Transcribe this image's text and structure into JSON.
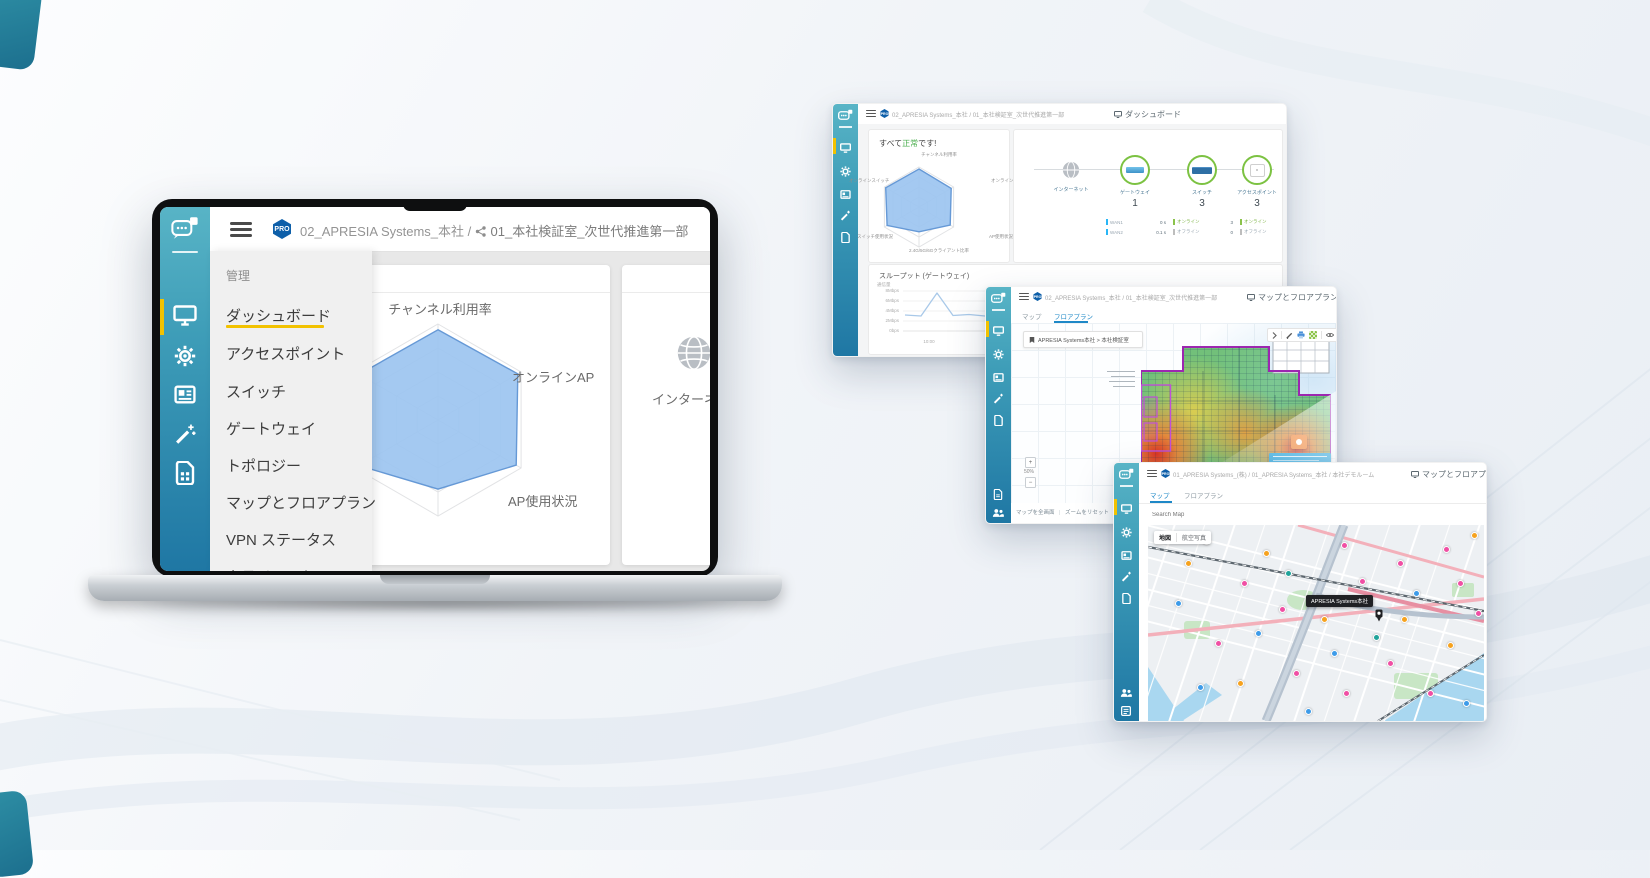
{
  "page": {
    "accent_teal": "#2E8FA5",
    "accent_yellow": "#F2C200",
    "sidebar_gradient_top": "#58B4C6",
    "sidebar_gradient_bottom": "#1F77A4",
    "pro_badge_color": "#0E5FA9"
  },
  "laptop": {
    "sidebar": {
      "icons": [
        "cloud-chat-logo",
        "monitor",
        "gear",
        "news-card",
        "magic-wand",
        "sim-card"
      ]
    },
    "header": {
      "pro": "PRO",
      "org": "02_APRESIA Systems_本社",
      "sep": "/",
      "site": "01_本社検証室_次世代推進第一部"
    },
    "menu": {
      "section": "管理",
      "items": [
        {
          "label": "ダッシュボード",
          "active": true
        },
        {
          "label": "アクセスポイント"
        },
        {
          "label": "スイッチ"
        },
        {
          "label": "ゲートウェイ"
        },
        {
          "label": "トポロジー"
        },
        {
          "label": "マップとフロアプラン"
        },
        {
          "label": "VPN ステータス"
        },
        {
          "label": "クライアント"
        }
      ]
    },
    "dashboard": {
      "radar_axis_top": "チャンネル利用率",
      "radar_axis_right": "オンラインAP",
      "radar_axis_bottom_right": "AP使用状況",
      "internet_label": "インターネット"
    }
  },
  "win_dashboard": {
    "header": {
      "pro": "PRO",
      "org": "02_APRESIA Systems_本社",
      "sep": "/",
      "site": "01_本社検証室_次世代推進第一部",
      "title": "ダッシュボード"
    },
    "status_card": {
      "prefix": "すべて",
      "status": "正常",
      "suffix": "です!",
      "status_color": "#4CAF50",
      "axes": {
        "top": "チャンネル利用率",
        "left": "オンラインスイッチ",
        "right": "オンラインAP",
        "bottom_left": "スイッチ使用状況",
        "bottom_right": "AP使用状況",
        "bottom": "2.4G/5G/6Gクライアント比率"
      }
    },
    "topology": {
      "internet_label": "インターネット",
      "nodes": [
        {
          "label": "ゲートウェイ",
          "count": "1",
          "device": "gateway",
          "stats": [
            {
              "name": "WAN1",
              "value": "0 s",
              "color": "#29B6F6"
            },
            {
              "name": "WAN2",
              "value": "0.1 s",
              "color": "#29B6F6"
            }
          ]
        },
        {
          "label": "スイッチ",
          "count": "3",
          "device": "switch",
          "stats": [
            {
              "name": "オンライン",
              "value": "3",
              "color": "#8BC34A"
            },
            {
              "name": "オフライン",
              "value": "0",
              "color": "#BDBDBD"
            }
          ]
        },
        {
          "label": "アクセスポイント",
          "count": "3",
          "device": "access-point",
          "stats": [
            {
              "name": "オンライン",
              "value": "3",
              "color": "#8BC34A"
            },
            {
              "name": "オフライン",
              "value": "0",
              "color": "#BDBDBD"
            }
          ]
        }
      ]
    },
    "throughput": {
      "title": "スループット (ゲートウェイ)",
      "ylabel": "通信量"
    }
  },
  "win_floorplan": {
    "header": {
      "pro": "PRO",
      "org": "02_APRESIA Systems_本社",
      "sep": "/",
      "site": "01_本社検証室_次世代推進第一部",
      "title": "マップとフロアプラン"
    },
    "tabs": [
      {
        "label": "マップ"
      },
      {
        "label": "フロアプラン",
        "active": true
      }
    ],
    "selector_label": "APRESIA Systems本社 > 本社検証室",
    "toolbar_icons": [
      "chevron-right",
      "pencil",
      "printer",
      "heatmap-grid",
      "eye"
    ],
    "zoom_in": "+",
    "zoom_value": "50%",
    "zoom_out": "−",
    "footer_left": "マップを全画面",
    "footer_sep": "|",
    "footer_right": "ズームをリセット"
  },
  "win_map": {
    "header": {
      "pro": "PRO",
      "breadcrumb": "01_APRESIA Systems_(株) / 01_APRESIA Systems_本社 / 本社デモルーム",
      "title": "マップとフロアプラン"
    },
    "tabs": [
      {
        "label": "マップ",
        "active": true
      },
      {
        "label": "フロアプラン"
      }
    ],
    "search_placeholder": "Search Map",
    "controls": {
      "map": "地図",
      "satellite": "航空写真"
    },
    "tooltip": "APRESIA Systems本社",
    "markers": [
      {
        "x": 58,
        "y": 16,
        "c": "#F04FA4"
      },
      {
        "x": 96,
        "y": 58,
        "c": "#F04FA4"
      },
      {
        "x": 134,
        "y": 84,
        "c": "#F04FA4"
      },
      {
        "x": 196,
        "y": 20,
        "c": "#F04FA4"
      },
      {
        "x": 214,
        "y": 56,
        "c": "#F04FA4"
      },
      {
        "x": 252,
        "y": 38,
        "c": "#F04FA4"
      },
      {
        "x": 298,
        "y": 24,
        "c": "#F04FA4"
      },
      {
        "x": 312,
        "y": 58,
        "c": "#F04FA4"
      },
      {
        "x": 330,
        "y": 88,
        "c": "#F04FA4"
      },
      {
        "x": 70,
        "y": 118,
        "c": "#F04FA4"
      },
      {
        "x": 148,
        "y": 148,
        "c": "#F04FA4"
      },
      {
        "x": 198,
        "y": 168,
        "c": "#F04FA4"
      },
      {
        "x": 242,
        "y": 138,
        "c": "#F04FA4"
      },
      {
        "x": 282,
        "y": 168,
        "c": "#F04FA4"
      },
      {
        "x": 40,
        "y": 38,
        "c": "#F6A21E"
      },
      {
        "x": 118,
        "y": 28,
        "c": "#F6A21E"
      },
      {
        "x": 176,
        "y": 94,
        "c": "#F6A21E"
      },
      {
        "x": 256,
        "y": 94,
        "c": "#F6A21E"
      },
      {
        "x": 326,
        "y": 10,
        "c": "#F6A21E"
      },
      {
        "x": 92,
        "y": 158,
        "c": "#F6A21E"
      },
      {
        "x": 302,
        "y": 120,
        "c": "#F6A21E"
      },
      {
        "x": 30,
        "y": 78,
        "c": "#3D9BE9"
      },
      {
        "x": 110,
        "y": 108,
        "c": "#3D9BE9"
      },
      {
        "x": 186,
        "y": 128,
        "c": "#3D9BE9"
      },
      {
        "x": 268,
        "y": 68,
        "c": "#3D9BE9"
      },
      {
        "x": 318,
        "y": 178,
        "c": "#3D9BE9"
      },
      {
        "x": 52,
        "y": 162,
        "c": "#3D9BE9"
      },
      {
        "x": 140,
        "y": 48,
        "c": "#20A39A"
      },
      {
        "x": 228,
        "y": 112,
        "c": "#20A39A"
      },
      {
        "x": 160,
        "y": 186,
        "c": "#3D9BE9"
      }
    ]
  },
  "chart_data": [
    {
      "type": "radar",
      "context": "laptop-dashboard",
      "axes": [
        "チャンネル利用率",
        "オンラインAP",
        "AP使用状況",
        "2.4G/5G/6Gクライアント比率",
        "スイッチ使用状況",
        "オンラインスイッチ"
      ],
      "values": [
        0.94,
        0.96,
        0.94,
        0.72,
        0.95,
        0.95
      ],
      "scale_max": 1,
      "grid": true
    },
    {
      "type": "radar",
      "context": "dashboard-window-status",
      "axes": [
        "チャンネル利用率",
        "オンラインAP",
        "AP使用状況",
        "2.4G/5G/6Gクライアント比率",
        "スイッチ使用状況",
        "オンラインスイッチ"
      ],
      "values": [
        0.95,
        0.93,
        0.9,
        0.62,
        0.92,
        0.96
      ],
      "scale_max": 1,
      "grid": true
    },
    {
      "type": "line",
      "context": "dashboard-window-throughput",
      "title": "スループット (ゲートウェイ)",
      "ylabel": "通信量",
      "yticks": [
        "8Mbps",
        "6Mbps",
        "4Mbps",
        "2Mbps",
        "0bps"
      ],
      "xticks": [
        "10:00",
        "11:00",
        "12:00",
        "13:00",
        "14:00"
      ],
      "unit": "Mbps",
      "ylim": [
        0,
        8
      ],
      "values": [
        3.2,
        3.0,
        7.6,
        3.1,
        3.3,
        3.0,
        3.2,
        3.4,
        3.1,
        3.3,
        3.0,
        3.2,
        3.4,
        3.1,
        3.3,
        3.2,
        3.0,
        3.4,
        3.2,
        3.3,
        3.1,
        3.4,
        3.2,
        3.5
      ]
    }
  ]
}
